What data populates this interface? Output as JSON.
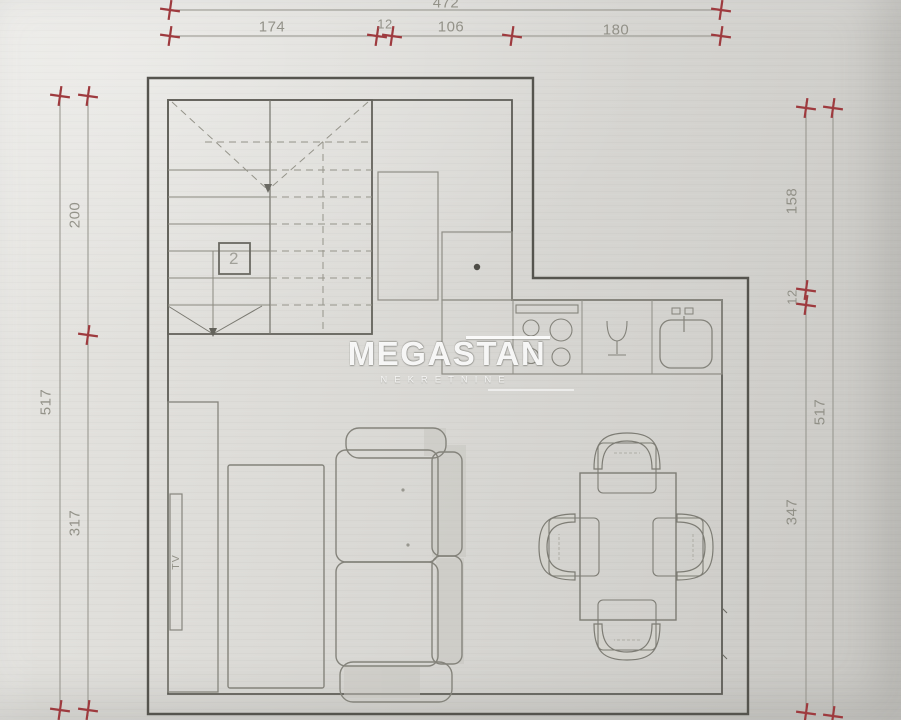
{
  "watermark": {
    "brand": "MEGASTAN",
    "subtitle": "NEKRETNINE"
  },
  "plan": {
    "floor_marker": "2",
    "tv_label": "TV",
    "dimensions": {
      "top_total": "472",
      "top_segments": [
        "174",
        "12",
        "106",
        "180"
      ],
      "left_total": "517",
      "left_segments": [
        "200",
        "317"
      ],
      "right_total": "517",
      "right_segments": [
        "158",
        "12",
        "347"
      ]
    },
    "colors": {
      "paper": "#d9d8d4",
      "wall_line": "#55544e",
      "furniture_line": "#8a897f",
      "dimension_line": "#93928a",
      "dimension_text": "#8b8a80",
      "tick_red": "#9e3a3e"
    }
  }
}
